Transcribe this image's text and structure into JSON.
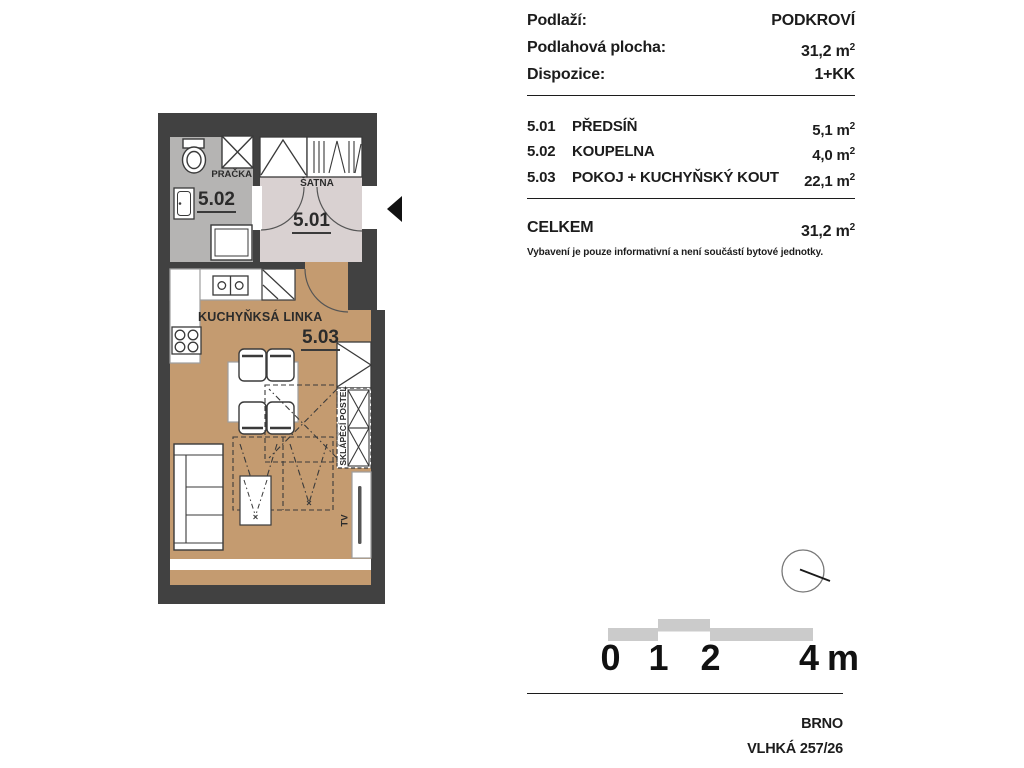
{
  "header": {
    "floor_label": "Podlaží:",
    "floor_value": "PODKROVÍ",
    "area_label": "Podlahová plocha:",
    "area_value": "31,2 m",
    "area_sup": "2",
    "layout_label": "Dispozice:",
    "layout_value": "1+KK"
  },
  "rooms": [
    {
      "code": "5.01",
      "name": "PŘEDSÍŇ",
      "area": "5,1 m",
      "sup": "2"
    },
    {
      "code": "5.02",
      "name": "KOUPELNA",
      "area": "4,0 m",
      "sup": "2"
    },
    {
      "code": "5.03",
      "name": "POKOJ + KUCHYŇSKÝ KOUT",
      "area": "22,1 m",
      "sup": "2"
    }
  ],
  "total": {
    "label": "CELKEM",
    "value": "31,2 m",
    "sup": "2"
  },
  "note": "Vybavení je pouze informativní a není součástí bytové jednotky.",
  "plan_labels": {
    "room_501": "5.01",
    "room_502": "5.02",
    "room_503": "5.03",
    "pracka": "PRAČKA",
    "satna": "ŠATNA",
    "kitchen": "KUCHYŇKSÁ LINKA",
    "fold_bed": "SKLÁPĚCÍ POSTEL",
    "tv": "TV"
  },
  "scale": {
    "t0": "0",
    "t1": "1",
    "t2": "2",
    "t4": "4 m"
  },
  "footer": {
    "city": "BRNO",
    "address": "VLHKÁ 257/26"
  },
  "colors": {
    "wall": "#414141",
    "floor_bathroom": "#b5b4b3",
    "floor_hall": "#d9d1d1",
    "floor_main": "#c49b70",
    "scalebar": "#cbcbcb"
  }
}
